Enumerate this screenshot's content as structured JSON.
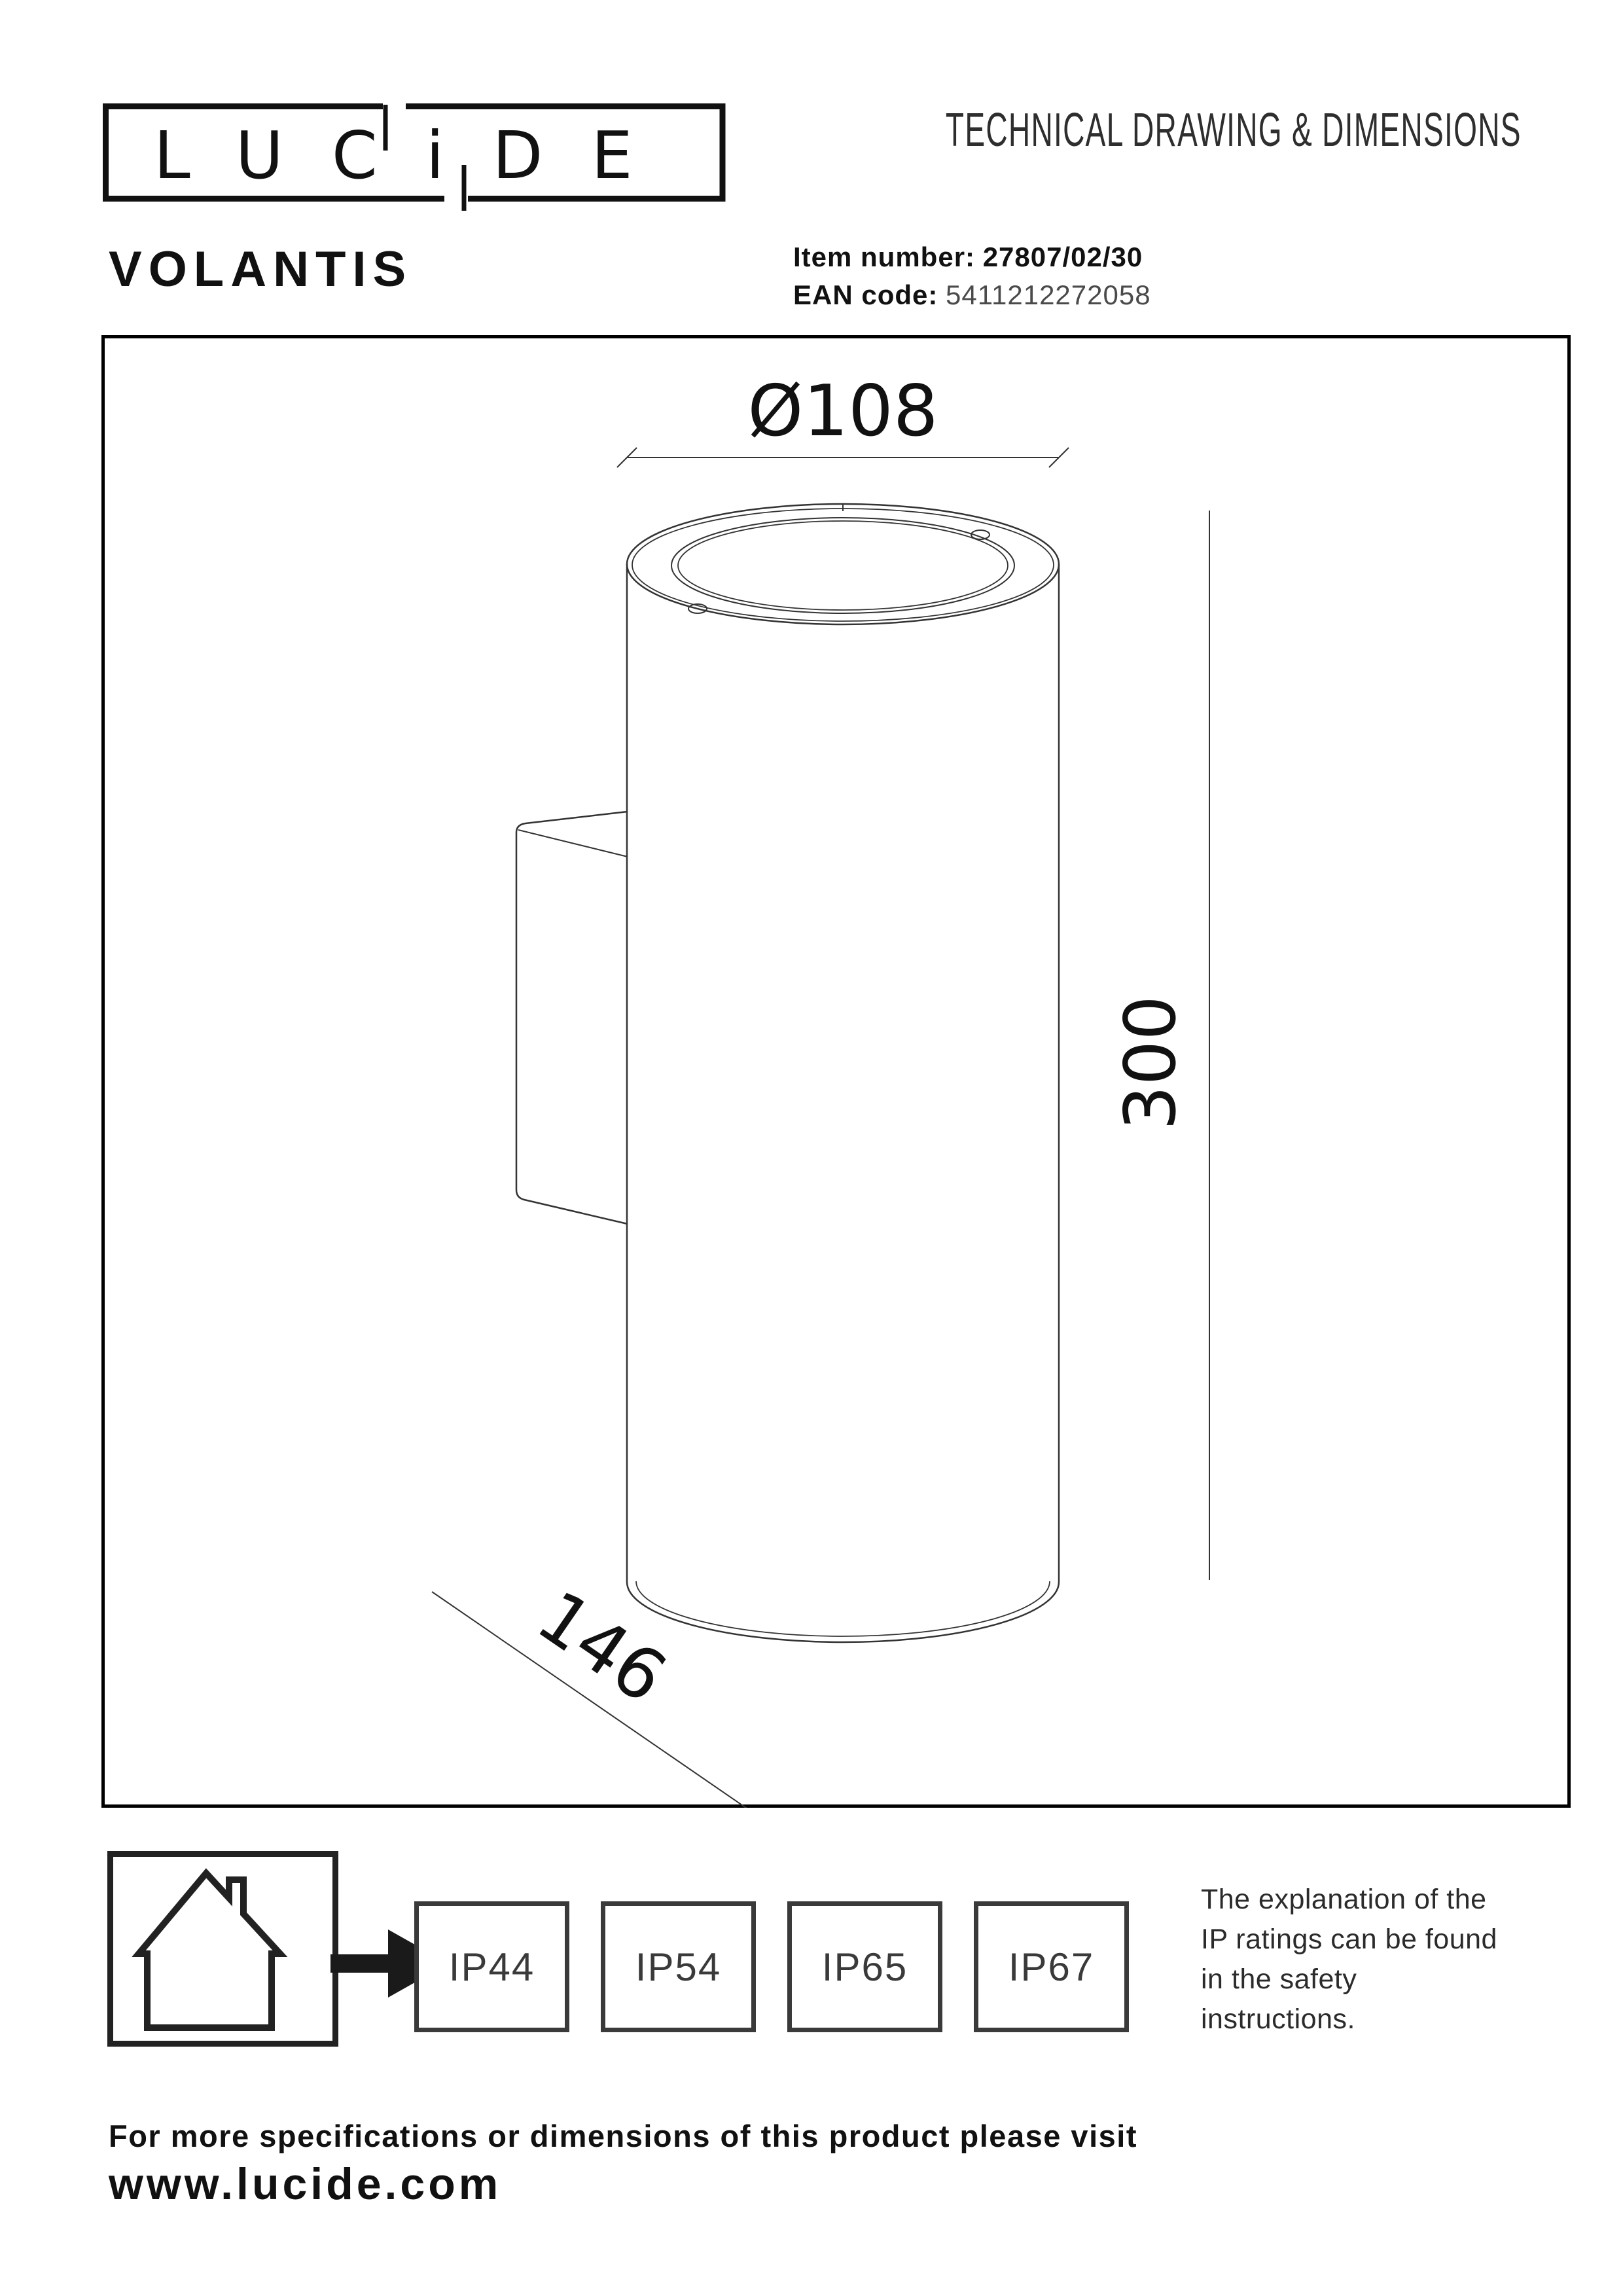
{
  "page": {
    "background": "#ffffff",
    "ink": "#1a1a1a"
  },
  "header": {
    "logo_text": "LUCiDE",
    "doc_title": "TECHNICAL DRAWING & DIMENSIONS",
    "product_name": "VOLANTIS",
    "item_label": "Item number:",
    "item_value": "27807/02/30",
    "ean_label": "EAN code:",
    "ean_value": "5411212272058"
  },
  "drawing": {
    "dim_diameter": "Ø108",
    "dim_height": "300",
    "dim_width": "146"
  },
  "ip_section": {
    "ratings": [
      {
        "label": "IP44"
      },
      {
        "label": "IP54"
      },
      {
        "label": "IP65"
      },
      {
        "label": "IP67"
      }
    ],
    "note_lines": [
      "The explanation of the",
      "IP ratings can be found",
      "in the safety",
      "instructions."
    ]
  },
  "footer": {
    "line1": "For more specifications or dimensions of this product please visit",
    "website": "www.lucide.com"
  }
}
